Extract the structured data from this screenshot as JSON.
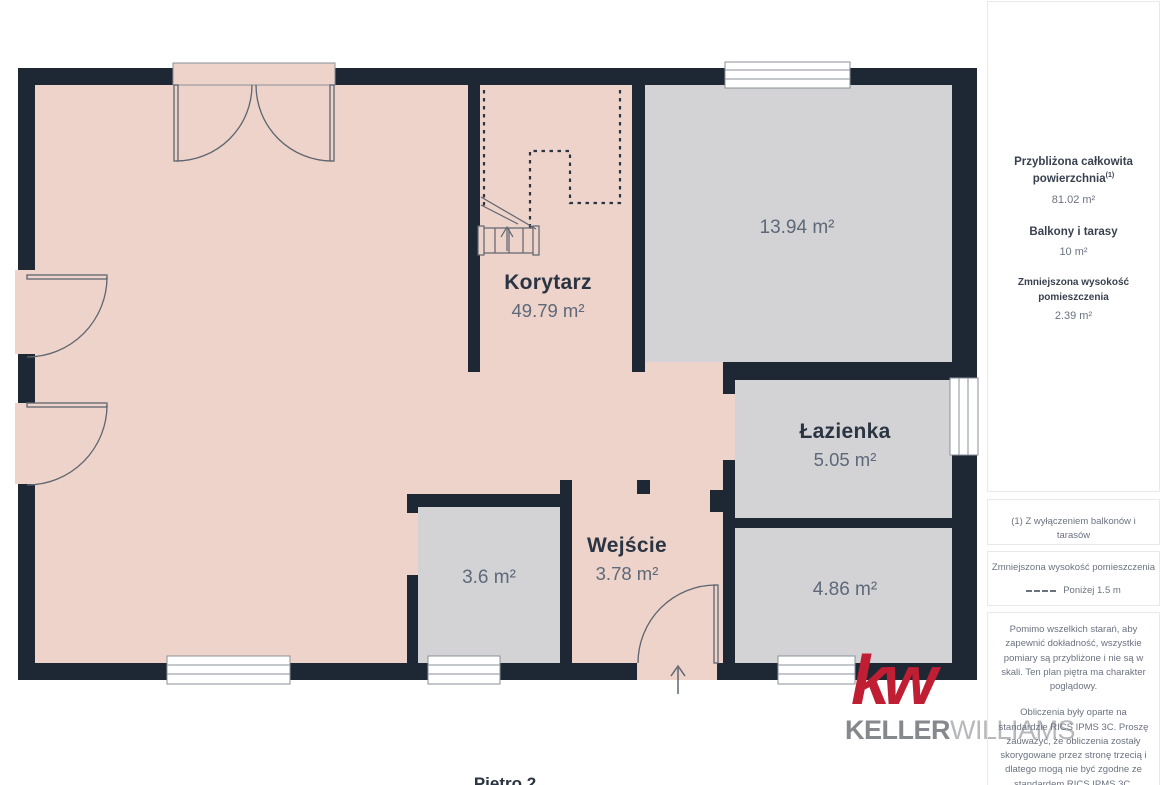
{
  "plan": {
    "rooms": {
      "korytarz": {
        "name": "Korytarz",
        "area": "49.79 m²"
      },
      "room_13": {
        "area": "13.94 m²"
      },
      "lazienka": {
        "name": "Łazienka",
        "area": "5.05 m²"
      },
      "wejscie": {
        "name": "Wejście",
        "area": "3.78 m²"
      },
      "room_36": {
        "area": "3.6 m²"
      },
      "room_486": {
        "area": "4.86 m²"
      }
    },
    "floor_title": "Piętro 2"
  },
  "sidebar": {
    "summary": [
      {
        "label": "Przybliżona całkowita powierzchnia",
        "sup": "(1)",
        "value": "81.02 m²"
      },
      {
        "label": "Balkony i tarasy",
        "value": "10 m²"
      },
      {
        "label": "Zmniejszona wysokość pomieszczenia",
        "value": "2.39 m²"
      }
    ],
    "footnote": "(1) Z wyłączeniem balkonów i tarasów",
    "legend": {
      "title": "Zmniejszona wysokość pomieszczenia",
      "label": "Poniżej 1.5 m"
    },
    "disclaimer_accuracy": "Pomimo wszelkich starań, aby zapewnić dokładność, wszystkie pomiary są przybliżone i nie są w skali. Ten plan piętra ma charakter poglądowy.",
    "disclaimer_standard": "Obliczenia były oparte na standardzie RICS IPMS 3C. Proszę zauważyć, że obliczenia zostały skorygowane przez stronę trzecią i dlatego mogą nie być zgodne ze standardem RICS IPMS 3C.",
    "brand": {
      "name": "GIRAFFE",
      "suffix": "360"
    }
  },
  "logo": {
    "monogram": "kw",
    "word1": "KELLER",
    "word2": "WILLIAMS"
  },
  "colors": {
    "wall": "#1d2834",
    "floor": "#edd3c9",
    "room_fill": "#d3d3d5",
    "line": "#5d6470",
    "text_dark": "#2a3442",
    "text_gray": "#5d6879",
    "brand_red": "#bf1e33"
  }
}
